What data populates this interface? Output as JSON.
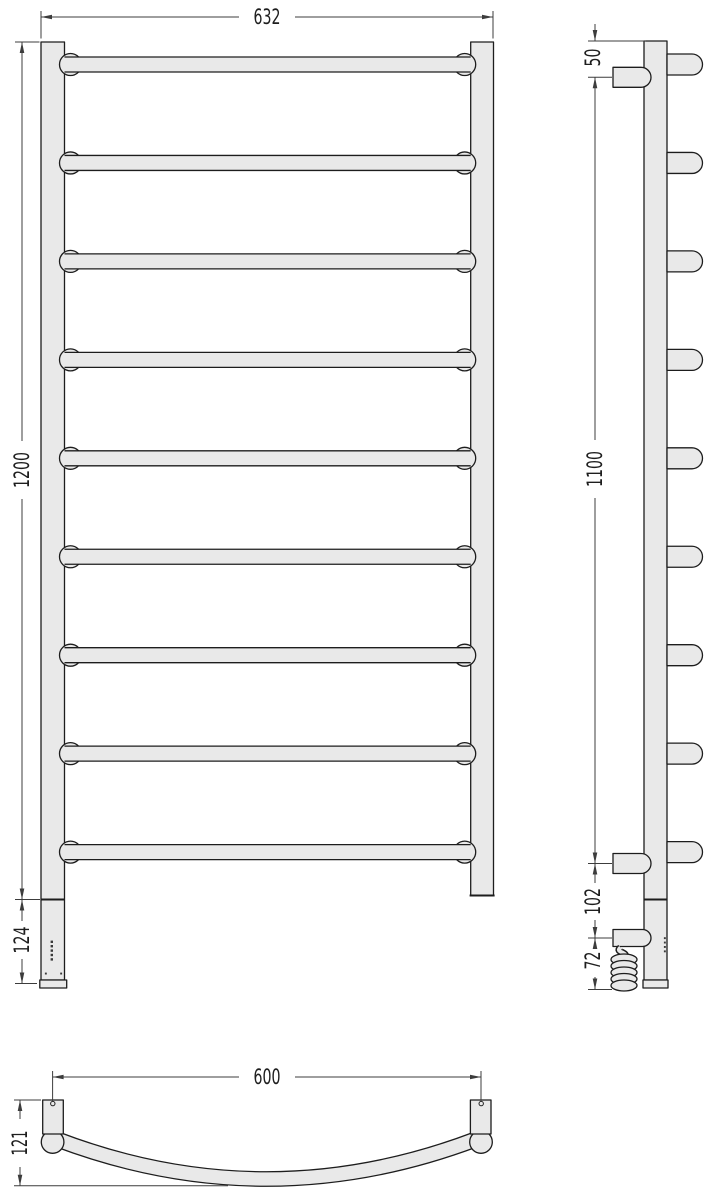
{
  "drawing": {
    "colors": {
      "fill": "#e9e9e9",
      "outline": "#1d1d1d",
      "dimension": "#3c3c3c",
      "background": "#ffffff"
    },
    "front_view": {
      "rung_count": 9,
      "dimensions": {
        "overall_width": "632",
        "overall_height": "1200",
        "control_section_height": "124"
      }
    },
    "side_view": {
      "rung_count": 9,
      "led_dot_count": 4,
      "coil_ring_count": 5,
      "dimensions": {
        "top_to_bracket": "50",
        "bracket_spacing": "1100",
        "bracket_to_outlet": "102",
        "cable_drop": "72"
      }
    },
    "bottom_view": {
      "dimensions": {
        "bracket_spacing": "600",
        "rail_depth": "121"
      }
    }
  }
}
